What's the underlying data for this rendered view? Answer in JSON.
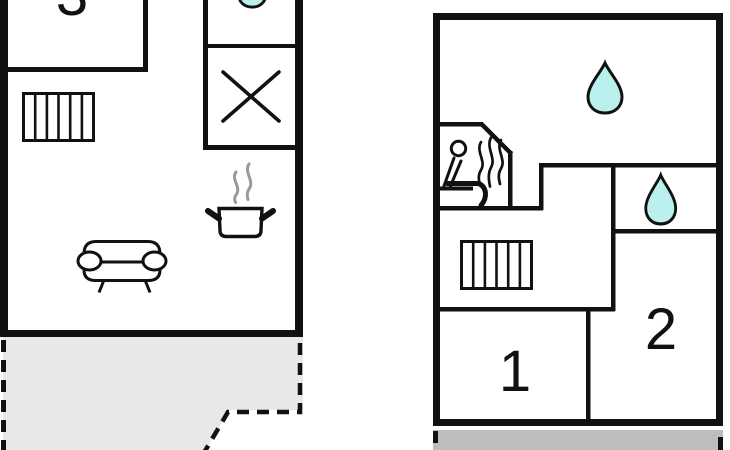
{
  "drawing": {
    "type": "holiday-home floor plan, two floors side by side",
    "floors": 2
  },
  "colors": {
    "line": "#111111",
    "water_drop_fill": "#B9F0EE",
    "terrace_light_fill": "#E8E8EB",
    "terrace_dark_fill": "#BDBDBD",
    "steam_gray": "#999999",
    "background": "#ffffff"
  },
  "floor1": {
    "name": "ground floor (left plan)",
    "rooms": [
      {
        "label": "3"
      }
    ],
    "icons": [
      "water-drop (bathroom, cut off at top)",
      "stove-cross (kitchen hob)",
      "radiator",
      "cooking-pot with steam",
      "sofa"
    ],
    "terrace": "grey patio below plan with dashed boundary, cut off at image bottom"
  },
  "floor2": {
    "name": "upper floor (right plan)",
    "rooms": [
      {
        "label": "1"
      },
      {
        "label": "2"
      }
    ],
    "icons": [
      "water-drop (large bathroom)",
      "water-drop (small bathroom)",
      "sauna (seated person with heat waves)",
      "radiator"
    ],
    "balcony": "grey strip below plan with dashed edge marks, cut off at image bottom"
  }
}
